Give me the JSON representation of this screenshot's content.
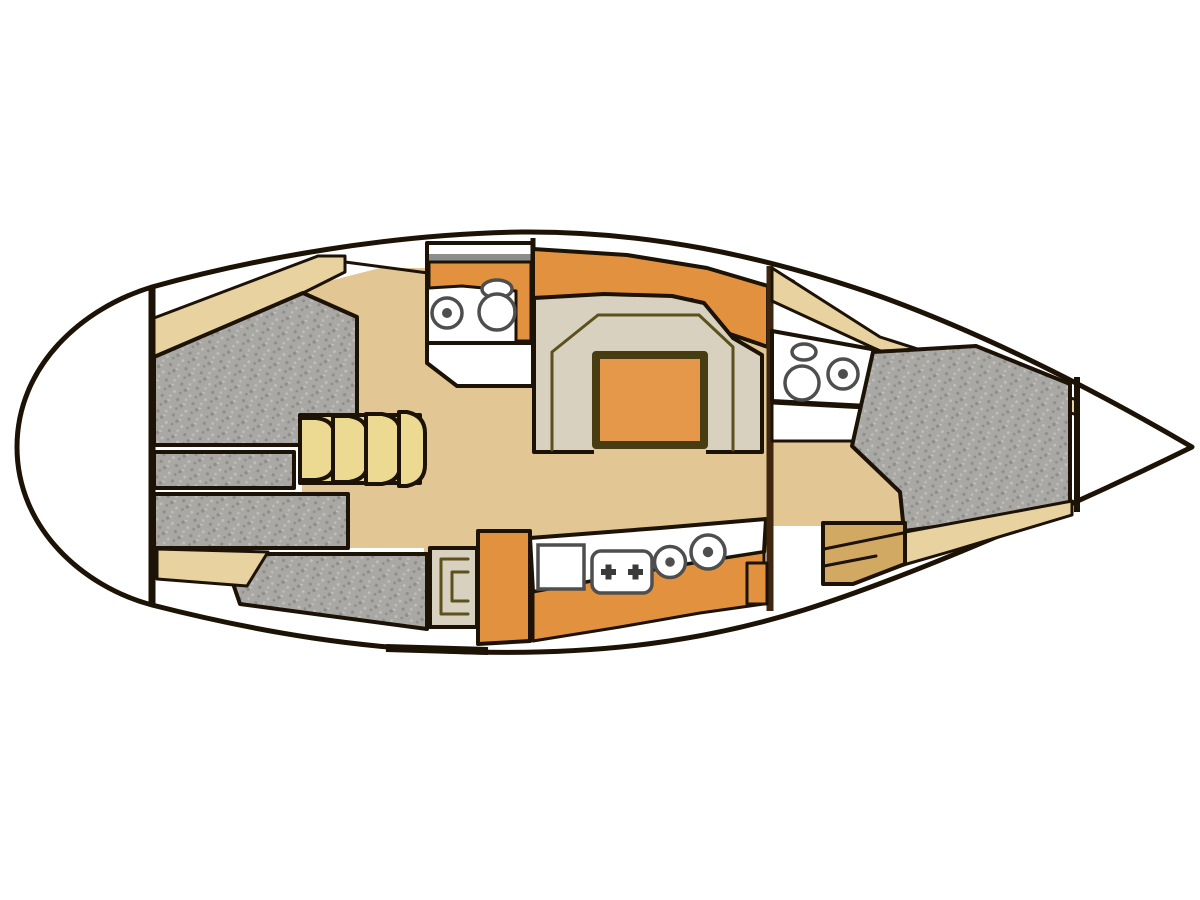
{
  "canvas": {
    "width": 1200,
    "height": 900
  },
  "diagram": {
    "kind": "sailboat-interior-layout-plan",
    "orientation": "bow-right-stern-left"
  },
  "colors": {
    "white": "#ffffff",
    "outline": "#1c1206",
    "brown": "#40260f",
    "floor": "#e2c694",
    "shelf": "#e8d2a0",
    "steps": "#ecd992",
    "cushion": "#a9a8a4",
    "cushion_dark": "#8f8e8a",
    "cushion_light": "#bfbeba",
    "settee": "#d8d1c0",
    "orange": "#e2923e",
    "table": "#e6984a",
    "table_border": "#473c12",
    "olive": "#5c501c",
    "wood": "#d2a963",
    "gray_strip": "#8d8d8d",
    "fixture": "#4e4e4e",
    "burner": "#3a3a3a"
  },
  "regions": [
    {
      "id": "stern-platform",
      "label": "Stern / transom platform"
    },
    {
      "id": "aft-cabin-berth",
      "label": "Aft cabin double berth (gray cushions)"
    },
    {
      "id": "companionway-steps",
      "label": "Companionway steps"
    },
    {
      "id": "aft-head",
      "label": "Aft head with sink and toilet"
    },
    {
      "id": "dinette",
      "label": "U-shaped dinette settee with table"
    },
    {
      "id": "salon-floor",
      "label": "Salon floor"
    },
    {
      "id": "galley",
      "label": "Galley with sink, stove and burners"
    },
    {
      "id": "chart-table",
      "label": "Chart table / nav seat"
    },
    {
      "id": "forward-head",
      "label": "Forward head with toilet and sink"
    },
    {
      "id": "v-berth",
      "label": "Forward cabin V-berth (gray cushion)"
    },
    {
      "id": "bow-locker",
      "label": "Bow / anchor locker"
    }
  ],
  "fixtures": [
    "aft-head-sink",
    "aft-head-toilet",
    "galley-sink",
    "galley-stove",
    "galley-burner-small",
    "galley-burner-large",
    "forward-head-toilet",
    "forward-head-sink"
  ]
}
